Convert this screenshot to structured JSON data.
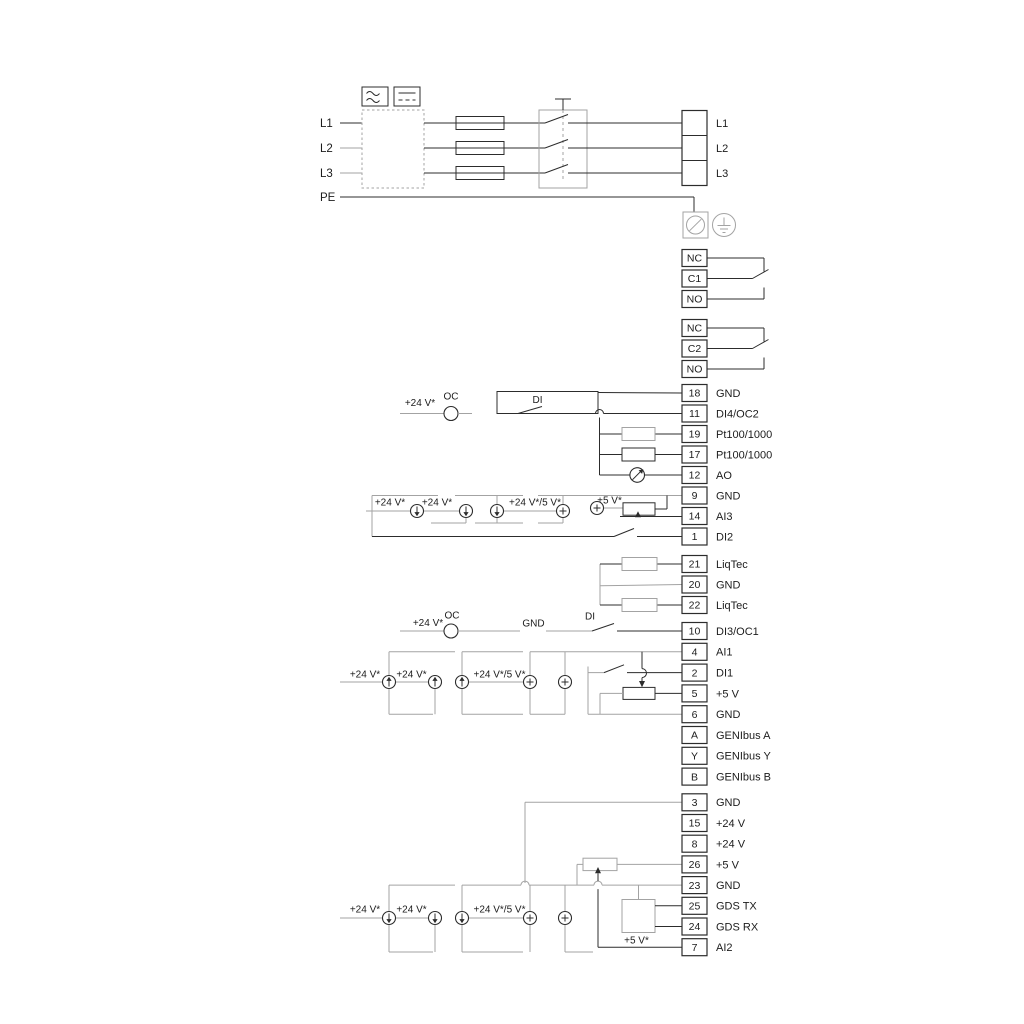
{
  "power": {
    "input_lines": [
      "L1",
      "L2",
      "L3",
      "PE"
    ],
    "output_terminals": [
      "L1",
      "L2",
      "L3"
    ]
  },
  "relays": [
    {
      "terminals": [
        "NC",
        "C1",
        "NO"
      ]
    },
    {
      "terminals": [
        "NC",
        "C2",
        "NO"
      ]
    }
  ],
  "terminal_groups": [
    {
      "terminals": [
        {
          "id": "18",
          "label": "GND"
        },
        {
          "id": "11",
          "label": "DI4/OC2"
        },
        {
          "id": "19",
          "label": "Pt100/1000"
        },
        {
          "id": "17",
          "label": "Pt100/1000"
        },
        {
          "id": "12",
          "label": "AO"
        },
        {
          "id": "9",
          "label": "GND"
        },
        {
          "id": "14",
          "label": "AI3"
        },
        {
          "id": "1",
          "label": "DI2"
        }
      ]
    },
    {
      "terminals": [
        {
          "id": "21",
          "label": "LiqTec"
        },
        {
          "id": "20",
          "label": "GND"
        },
        {
          "id": "22",
          "label": "LiqTec"
        }
      ]
    },
    {
      "terminals": [
        {
          "id": "10",
          "label": "DI3/OC1"
        },
        {
          "id": "4",
          "label": "AI1"
        },
        {
          "id": "2",
          "label": "DI1"
        },
        {
          "id": "5",
          "label": "+5 V"
        },
        {
          "id": "6",
          "label": "GND"
        },
        {
          "id": "A",
          "label": "GENIbus A"
        },
        {
          "id": "Y",
          "label": "GENIbus Y"
        },
        {
          "id": "B",
          "label": "GENIbus B"
        }
      ]
    },
    {
      "terminals": [
        {
          "id": "3",
          "label": "GND"
        },
        {
          "id": "15",
          "label": "+24 V"
        },
        {
          "id": "8",
          "label": "+24 V"
        },
        {
          "id": "26",
          "label": "+5 V"
        },
        {
          "id": "23",
          "label": "GND"
        },
        {
          "id": "25",
          "label": "GDS TX"
        },
        {
          "id": "24",
          "label": "GDS RX"
        },
        {
          "id": "7",
          "label": "AI2"
        }
      ]
    }
  ],
  "ann": {
    "v24": "+24 V*",
    "v24_5": "+24 V*/5 V*",
    "v5": "+5 V*",
    "oc": "OC",
    "di": "DI",
    "gnd": "GND"
  },
  "colors": {
    "wire": "#2c2c2c",
    "wire_alt": "#a3a3a3"
  }
}
